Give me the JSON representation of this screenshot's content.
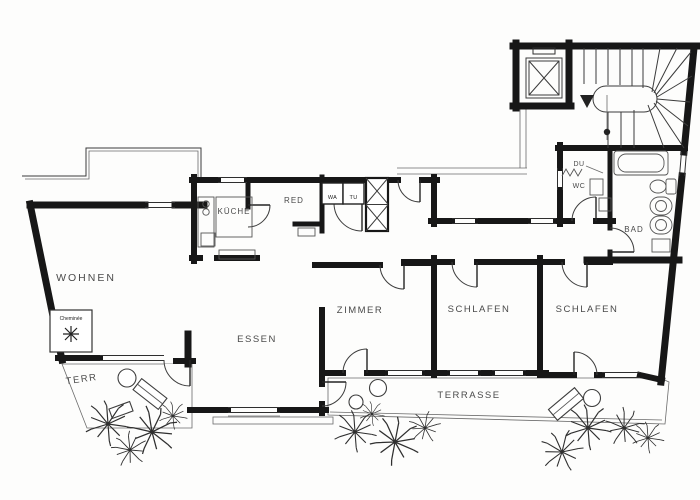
{
  "plan_type": "apartment-floor-plan",
  "labels": {
    "wohnen": "WOHNEN",
    "kueche": "KÜCHE",
    "red": "RED",
    "wa": "WA",
    "tu": "TU",
    "du": "DU",
    "wc": "WC",
    "bad": "BAD",
    "zimmer": "ZIMMER",
    "essen": "ESSEN",
    "schlafen_1": "SCHLAFEN",
    "schlafen_2": "SCHLAFEN",
    "terr": "TERR",
    "terrasse": "TERRASSE",
    "cheminee": "Cheminée"
  },
  "icons": {
    "fireplace": "eight-point-star",
    "elevator": "crossed-box",
    "duct_shaft": "crossed-box",
    "staircase": "winder-stairs-with-direction-arrow",
    "shower": "zigzag",
    "terrace_floor": "vertical-hatching",
    "plants": "line-burst-shrubs"
  },
  "colors": {
    "wall": "#171717",
    "line": "#3b3b3b",
    "hatch": "#9a9a9a",
    "paper": "#fdfdfc",
    "text": "#242424",
    "muted_text": "#4a4a4a"
  }
}
